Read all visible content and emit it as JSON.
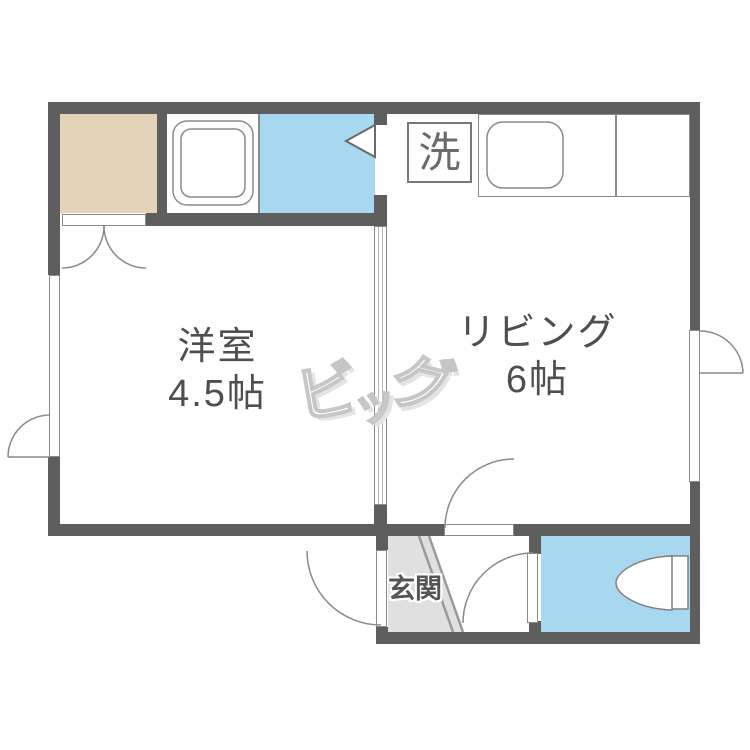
{
  "plan": {
    "rooms": {
      "western_room": {
        "name": "洋室",
        "size": "4.5帖"
      },
      "living": {
        "name": "リビング",
        "size": "6帖"
      },
      "entrance": {
        "name": "玄関"
      },
      "washer_area": {
        "label": "洗"
      }
    },
    "watermark": {
      "text": "ビッグ",
      "chars": [
        "ビ",
        "ッ",
        "グ"
      ]
    },
    "icons": {
      "bathtub-icon": "double rounded rectangle",
      "kitchen-sink-icon": "rounded rectangle in counter",
      "washing-machine-icon": "boxed kanji 洗",
      "toilet-icon": "bowl with tank against right wall",
      "door-swing-icon": "quarter-circle arc with leaf",
      "closet-double-door-icon": "twin quarter arcs",
      "sliding-partition-icon": "double-line white strip",
      "window-icon": "white gap strip in wall",
      "bath-door-icon": "white triangle pointing left",
      "entrance-step-icon": "double diagonal lines"
    },
    "colors": {
      "wall": "#5e5e5e",
      "thin_line": "#8a8a8a",
      "closet_fill": "#e5d3b9",
      "bath_fill": "#a7d8f0",
      "toilet_fill": "#a7d8f0",
      "entrance_fill": "#e0e0e0",
      "label_text": "#4f4f4f",
      "watermark": "#c6c6c6",
      "background": "#ffffff"
    }
  }
}
